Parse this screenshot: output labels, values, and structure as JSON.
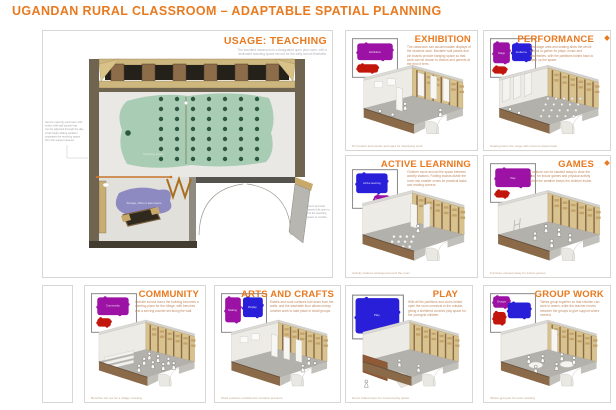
{
  "header": {
    "title": "UGANDAN RURAL CLASSROOM –  ADAPTABLE SPATIAL PLANNING",
    "accent_color": "#e87a20"
  },
  "main_panel": {
    "title": "USAGE: TEACHING",
    "description": [
      "The standard classroom is a designated open plan room, with a",
      "dedicated teaching space set out for the daily school timetable."
    ],
    "plan": {
      "teaching_space_label": "Teaching space",
      "storage_label": "Storage, office or quiet space",
      "left_annotation": [
        "Secure masonry perimeter with",
        "timber infill wall panels that",
        "can be adjusted through the day.",
        "A full height sliding partition",
        "separates the teaching space",
        "from the support spaces."
      ],
      "right_annotation": [
        "Doors and wall",
        "panels fold open to",
        "link the teaching",
        "space to outside."
      ]
    }
  },
  "panels": [
    {
      "id": "exhibition",
      "title": "EXHIBITION",
      "map": {
        "labels": [
          "Exhibition"
        ]
      },
      "description": "The classroom can accommodate displays of the students work. Movable wall panels and pin boards provide hanging space so that work can be shown to visitors and parents at the end of term.",
      "caption": "Pin boards and panels arranged for displaying work"
    },
    {
      "id": "performance",
      "title": "PERFORMANCE",
      "map": {
        "labels": [
          "Stage",
          "Audience"
        ]
      },
      "description": "The stage area and seating allow the whole school to gather for plays, music and assemblies, with the partitions folded back to open up the space.",
      "caption": "Seating faces the stage with screens drawn back"
    },
    {
      "id": "active-learning",
      "title": "ACTIVE LEARNING",
      "map": {
        "labels": [
          "Active learning",
          "Resources"
        ]
      },
      "description": "Children move around the space between activity stations. Folding boards divide the room into smaller zones for practical tasks and reading corners.",
      "caption": "Activity stations arranged around the room"
    },
    {
      "id": "games",
      "title": "GAMES",
      "map": {
        "labels": [
          "Play"
        ]
      },
      "description": "Furniture can be stacked away to clear the floor for indoor games and physical activity when the weather keeps the children inside.",
      "caption": "Furniture cleared away for indoor games"
    },
    {
      "id": "community",
      "title": "COMMUNITY",
      "map": {
        "labels": [
          "Community"
        ]
      },
      "description": "Outside school hours the building becomes a meeting place for the village, with benches and a serving counter set along the wall.",
      "caption": "Benches set out for a village meeting"
    },
    {
      "id": "arts-and-crafts",
      "title": "ARTS AND CRAFTS",
      "map": {
        "labels": [
          "Making",
          "Display"
        ]
      },
      "description": "Easels and work surfaces fold down from the walls, and the washable floor allows messy creative work to take place in small groups.",
      "caption": "Work surfaces unfolded for creative sessions"
    },
    {
      "id": "play",
      "title": "PLAY",
      "map": {
        "labels": [
          "Play"
        ]
      },
      "description": "With all the partitions and doors folded open the room connects to the outside, giving a sheltered covered play space for the youngest children.",
      "caption": "Doors folded open for covered play space"
    },
    {
      "id": "group-work",
      "title": "GROUP WORK",
      "map": {
        "labels": [
          "Groups"
        ]
      },
      "description": "Tables group together so that children can work in teams, while the teacher moves between the groups to give support where needed.",
      "caption": "Tables grouped for team working"
    }
  ]
}
